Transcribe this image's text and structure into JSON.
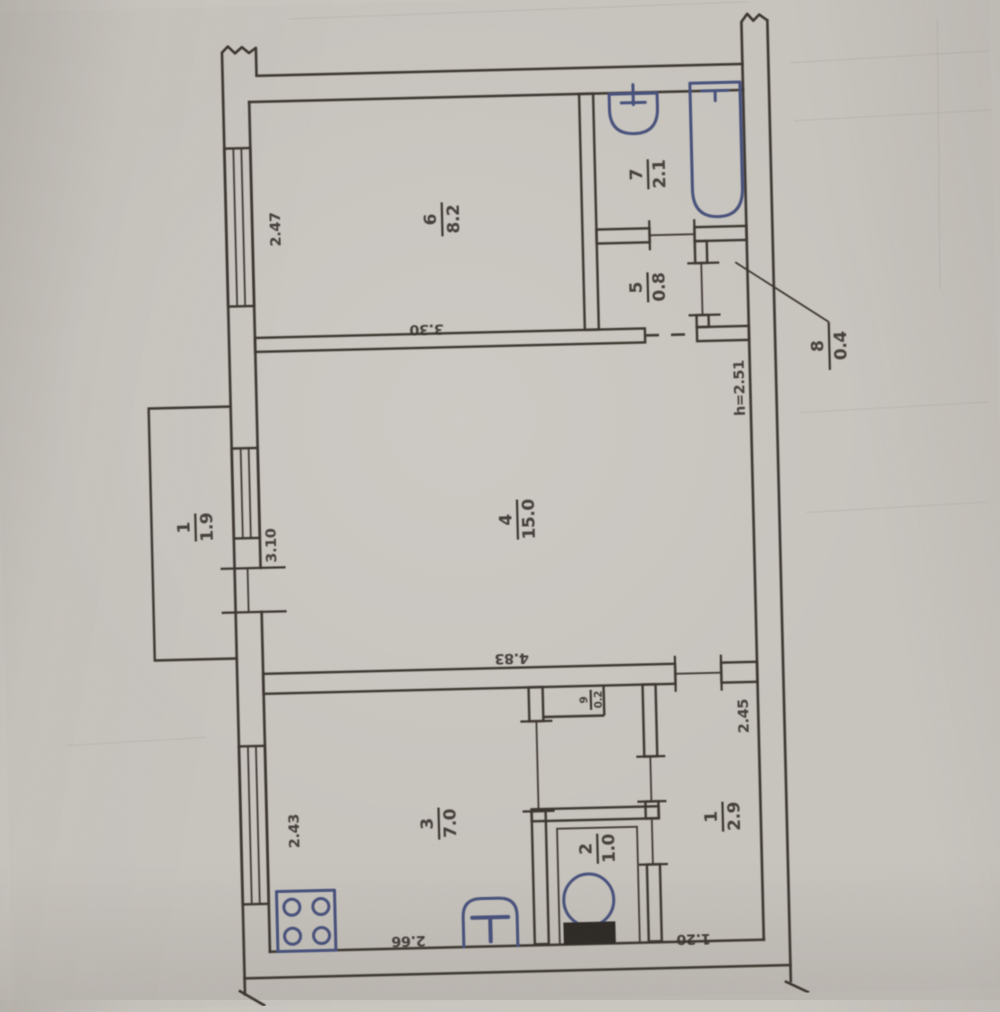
{
  "plan": {
    "rooms": [
      {
        "number": "6",
        "area": "8.2"
      },
      {
        "number": "7",
        "area": "2.1"
      },
      {
        "number": "5",
        "area": "0.8"
      },
      {
        "number": "8",
        "area": "0.4"
      },
      {
        "number": "4",
        "area": "15.0"
      },
      {
        "number": "9",
        "area": "0.2"
      },
      {
        "number": "3",
        "area": "7.0"
      },
      {
        "number": "2",
        "area": "1.0"
      },
      {
        "number": "1",
        "area": "2.9"
      },
      {
        "number": "1",
        "area": "1.9"
      }
    ],
    "dimensions": {
      "room6_width": "2.47",
      "room6_length": "3.30",
      "room4_width": "3.10",
      "room4_length": "4.83",
      "room3_width": "2.43",
      "room3_length": "2.66",
      "hall_length": "2.45",
      "hall_width": "1.20",
      "ceiling_height": "h=2.51"
    },
    "colors": {
      "ink": "#3a352f",
      "fixture": "#47517c",
      "paper": "#c9c5bf"
    }
  }
}
